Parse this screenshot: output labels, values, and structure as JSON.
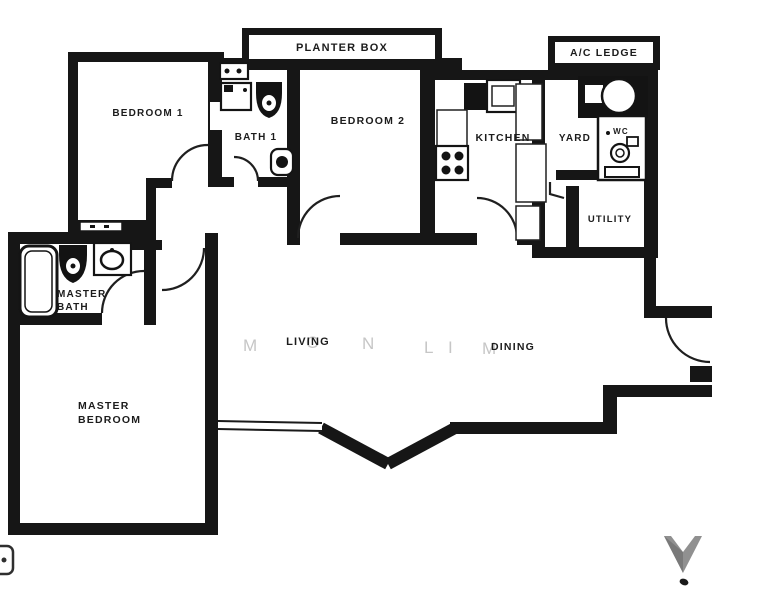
{
  "labels": {
    "planter_box": "PLANTER BOX",
    "ac_ledge": "A/C LEDGE",
    "bedroom1": "BEDROOM 1",
    "bath1": "BATH 1",
    "bedroom2": "BEDROOM 2",
    "kitchen": "KITCHEN",
    "yard": "YARD",
    "wc": "WC",
    "utility": "UTILITY",
    "master_bath_line1": "MASTER",
    "master_bath_line2": "BATH",
    "master_bedroom_line1": "MASTER",
    "master_bedroom_line2": "BEDROOM",
    "living": "LIVING",
    "dining": "DINING"
  },
  "watermark": {
    "letters": [
      "M",
      "O",
      "N",
      "L",
      "I",
      "M"
    ],
    "color": "#c6c6c6"
  },
  "colors": {
    "ink": "#161616",
    "background": "#ffffff",
    "north_arrow": "#909090"
  }
}
